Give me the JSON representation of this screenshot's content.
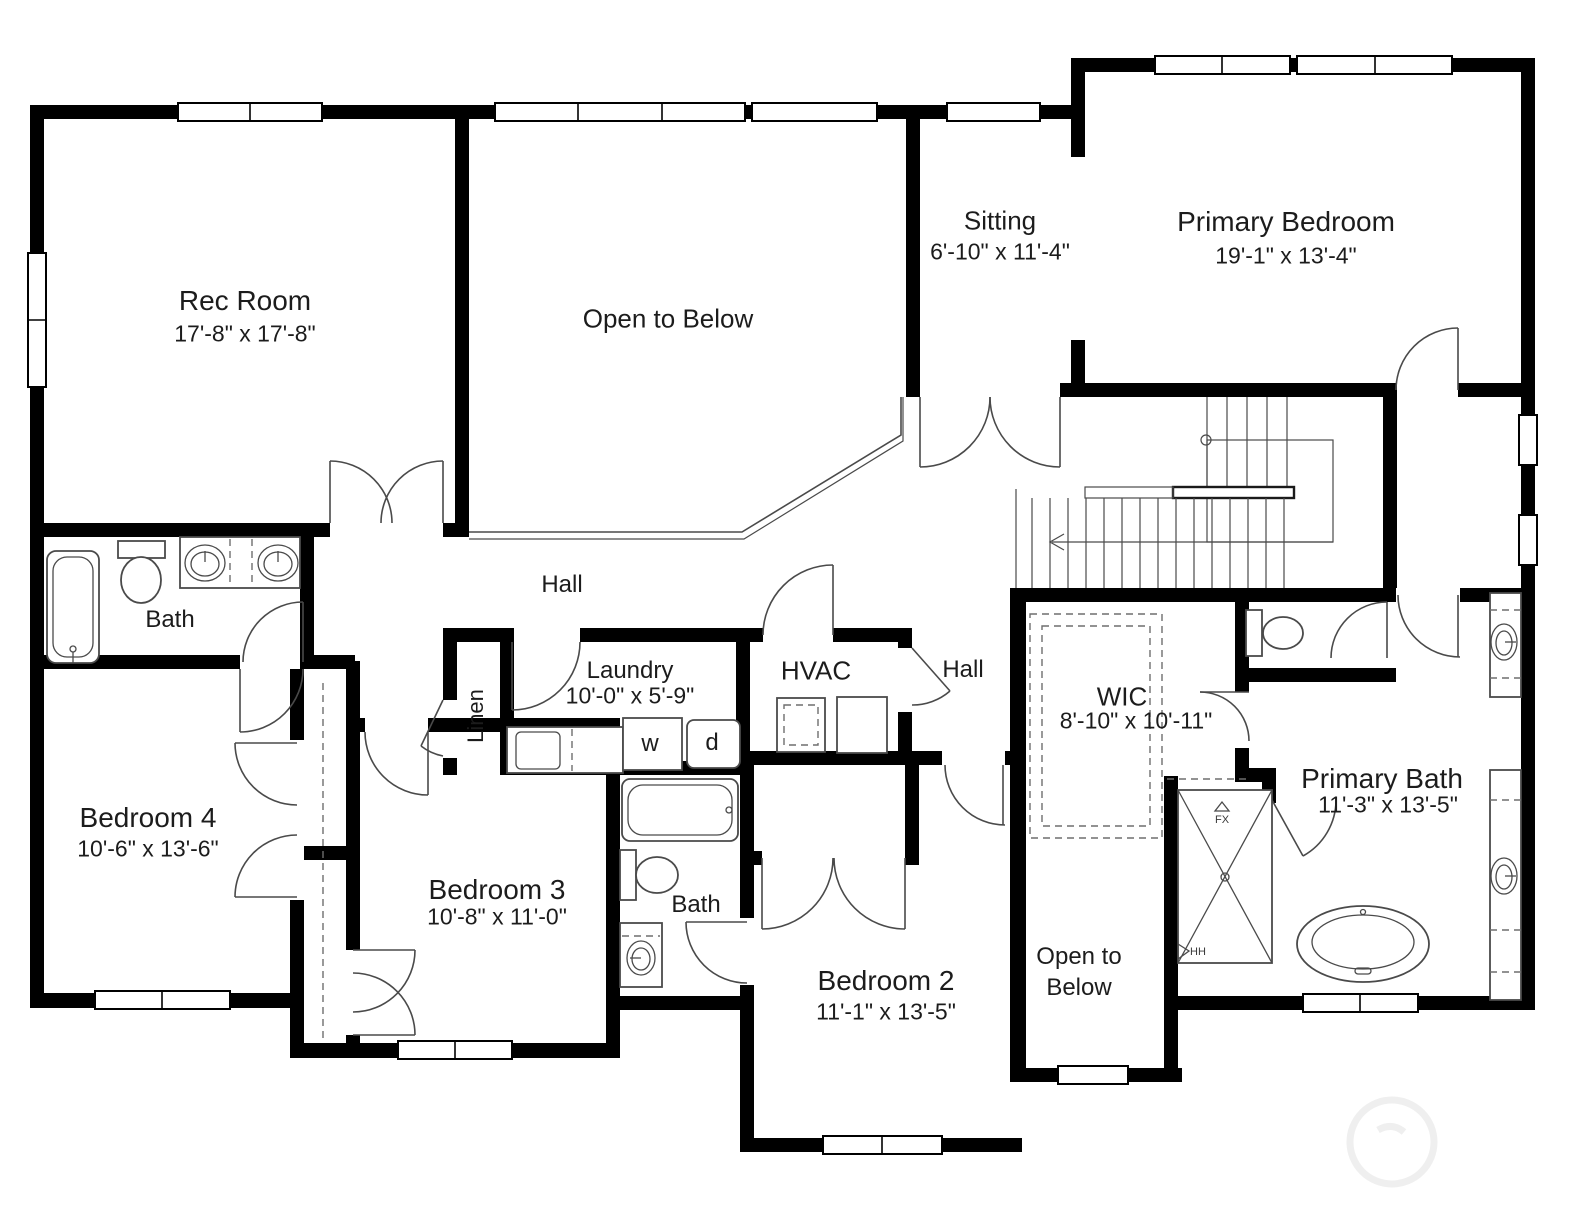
{
  "colors": {
    "wall": "#000000",
    "line": "#4a4a4a",
    "dashed": "#6e6e6e",
    "text": "#1c1c1c",
    "background": "#ffffff",
    "watermark": "#efefef"
  },
  "rooms": {
    "rec_room": {
      "name": "Rec Room",
      "dims": "17'-8\" x 17'-8\""
    },
    "open_below_top": {
      "name": "Open to Below"
    },
    "sitting": {
      "name": "Sitting",
      "dims": "6'-10\" x 11'-4\""
    },
    "primary_bedroom": {
      "name": "Primary Bedroom",
      "dims": "19'-1\" x 13'-4\""
    },
    "hall_left": {
      "name": "Hall"
    },
    "hall_right": {
      "name": "Hall"
    },
    "bath_left": {
      "name": "Bath"
    },
    "laundry": {
      "name": "Laundry",
      "dims": "10'-0\" x 5'-9\""
    },
    "hvac": {
      "name": "HVAC"
    },
    "linen": {
      "name": "Linen"
    },
    "wic": {
      "name": "WIC",
      "dims": "8'-10\" x 10'-11\""
    },
    "primary_bath": {
      "name": "Primary Bath",
      "dims": "11'-3\" x 13'-5\""
    },
    "bedroom4": {
      "name": "Bedroom 4",
      "dims": "10'-6\" x 13'-6\""
    },
    "bedroom3": {
      "name": "Bedroom 3",
      "dims": "10'-8\" x 11'-0\""
    },
    "bath_middle": {
      "name": "Bath"
    },
    "bedroom2": {
      "name": "Bedroom 2",
      "dims": "11'-1\" x 13'-5\""
    },
    "open_below_bottom": {
      "line1": "Open to",
      "line2": "Below"
    }
  },
  "appliances": {
    "washer": "w",
    "dryer": "d"
  },
  "annotations": {
    "shower_fixture": "FX",
    "shower_hh": "HH"
  }
}
